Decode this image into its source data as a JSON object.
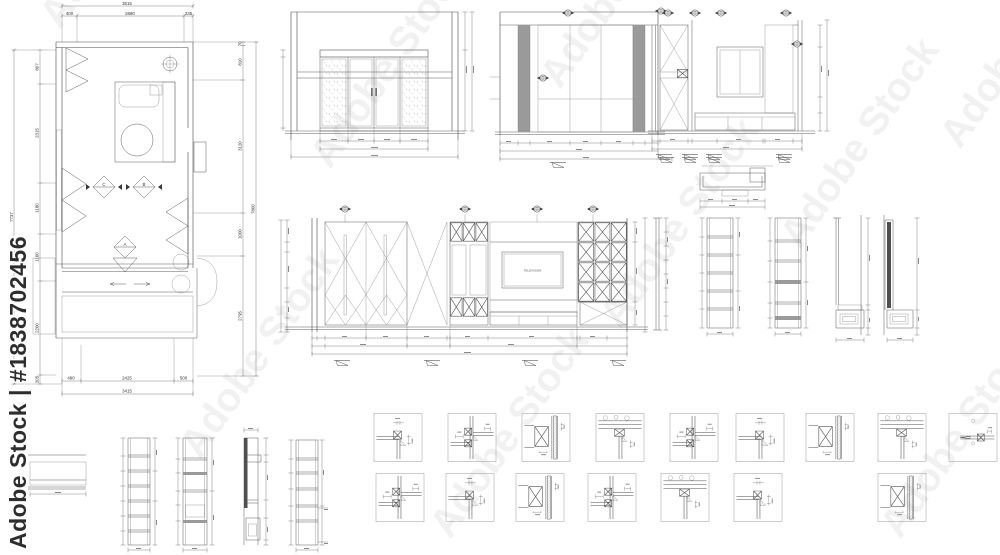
{
  "watermark": {
    "side_text": "Adobe Stock | #1838702456",
    "tile_text": "Adobe Stock"
  },
  "floor_plan": {
    "dim_top_overall": "3515",
    "dim_top_seg_1": "400",
    "dim_top_seg_2": "2880",
    "dim_top_seg_3": "235",
    "dim_bottom_seg_1": "490",
    "dim_bottom_seg_2": "2425",
    "dim_bottom_seg_3": "500",
    "dim_bottom_overall": "3415",
    "dim_left_overall": "7737",
    "dim_left_seg_1": "807",
    "dim_left_seg_2": "2315",
    "dim_left_seg_3": "1180",
    "dim_left_seg_4": "1100",
    "dim_left_seg_5": "2200",
    "dim_left_seg_6": "205",
    "dim_right_seg_1": "70",
    "dim_right_seg_2": "810",
    "dim_right_seg_3": "3120",
    "dim_right_seg_4": "1000",
    "dim_right_seg_5": "2795",
    "dim_right_overall": "7800",
    "marker_a": "A",
    "marker_b": "B",
    "marker_c": "C"
  },
  "tv_wall": {
    "label": "TELEVISION"
  }
}
